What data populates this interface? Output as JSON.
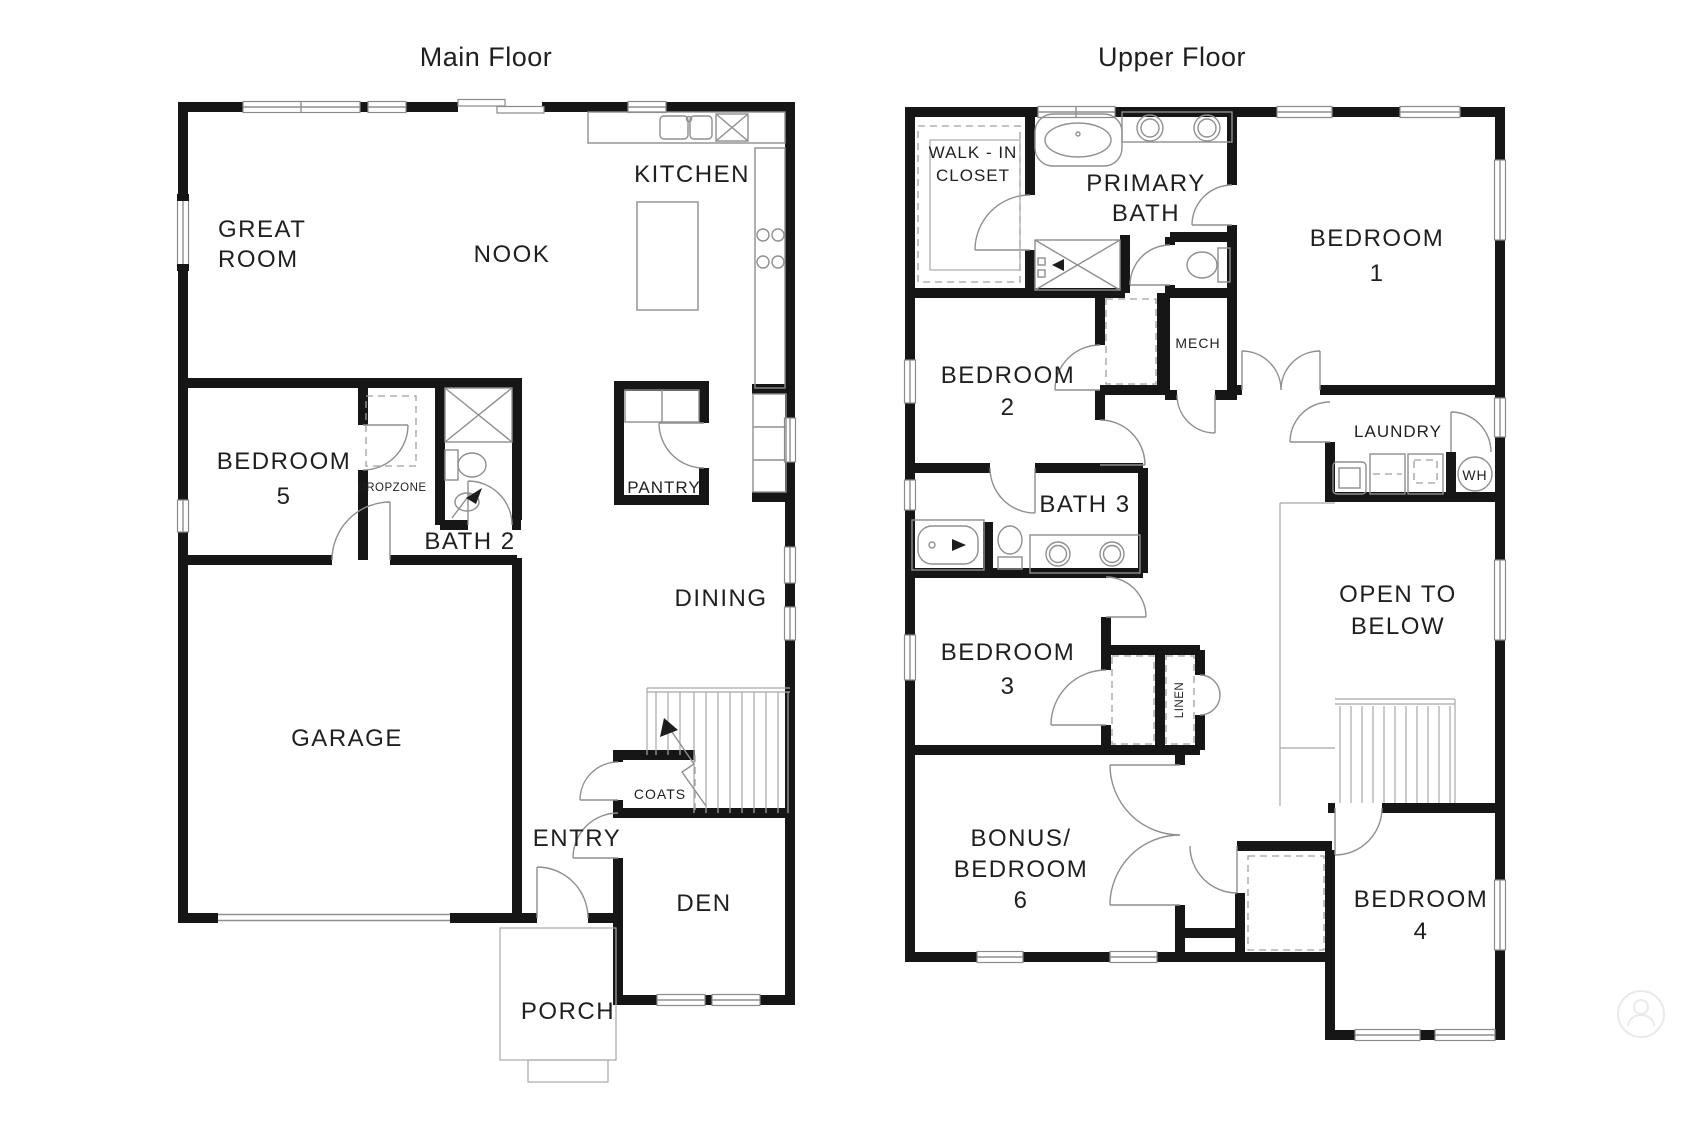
{
  "main_floor": {
    "title": "Main Floor",
    "rooms": {
      "great_room_line1": "GREAT",
      "great_room_line2": "ROOM",
      "kitchen": "KITCHEN",
      "nook": "NOOK",
      "bedroom5_line1": "BEDROOM",
      "bedroom5_line2": "5",
      "dropzone": "DROPZONE",
      "bath2": "BATH 2",
      "pantry": "PANTRY",
      "dining": "DINING",
      "garage": "GARAGE",
      "coats": "COATS",
      "entry": "ENTRY",
      "den": "DEN",
      "porch": "PORCH"
    }
  },
  "upper_floor": {
    "title": "Upper Floor",
    "rooms": {
      "walk_in_line1": "WALK - IN",
      "walk_in_line2": "CLOSET",
      "primary_bath_line1": "PRIMARY",
      "primary_bath_line2": "BATH",
      "bedroom1_line1": "BEDROOM",
      "bedroom1_line2": "1",
      "bedroom2_line1": "BEDROOM",
      "bedroom2_line2": "2",
      "mech": "MECH",
      "laundry": "LAUNDRY",
      "water_heater": "WH",
      "bath3": "BATH 3",
      "bedroom3_line1": "BEDROOM",
      "bedroom3_line2": "3",
      "linen": "LINEN",
      "open_to_below_line1": "OPEN TO",
      "open_to_below_line2": "BELOW",
      "bonus_line1": "BONUS/",
      "bonus_line2": "BEDROOM",
      "bonus_line3": "6",
      "bedroom4_line1": "BEDROOM",
      "bedroom4_line2": "4"
    }
  }
}
